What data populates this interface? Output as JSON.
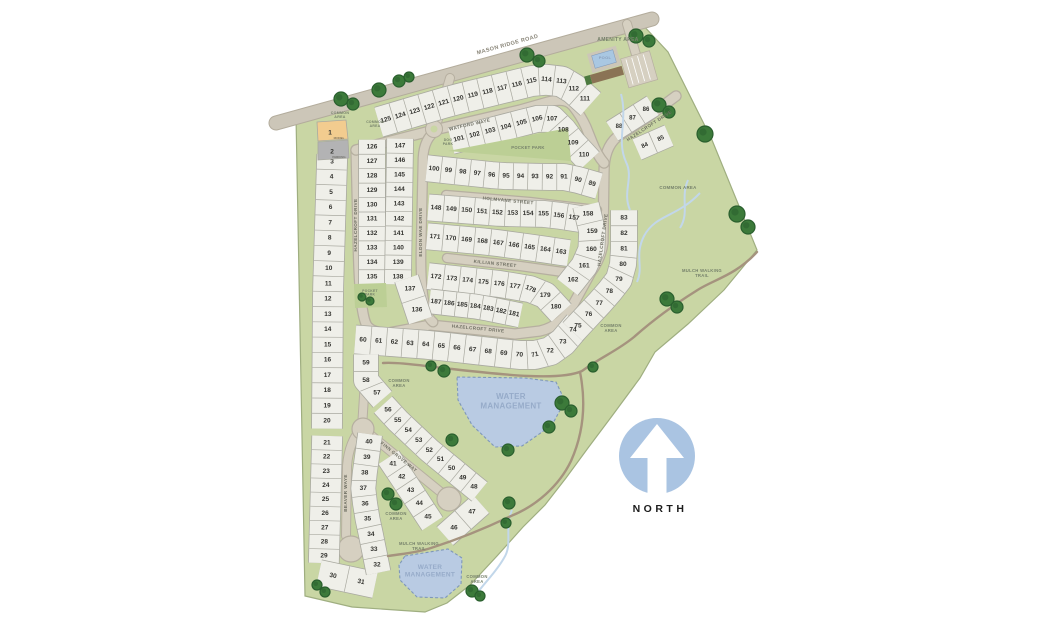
{
  "north": {
    "label": "NORTH"
  },
  "colors": {
    "background": "#ffffff",
    "parcel_green": "#c9d6a4",
    "parcel_edge": "#9fae80",
    "pocket_green": "#bccf95",
    "lot_fill": "#efefe9",
    "lot_edge": "#a9a9a0",
    "road_fill": "#d6d0c1",
    "road_edge": "#b6afa0",
    "main_road_fill": "#ccc6b8",
    "main_road_edge": "#b3ac9c",
    "water_fill": "#b9cbe3",
    "water_edge": "#7e97ba",
    "water_text": "#96abc9",
    "stream": "#c2d7ea",
    "trail": "#a5937e",
    "tree_dark": "#2a5f2e",
    "tree_mid": "#3c7a3a",
    "lot_number_text": "#33332f",
    "street_text": "#6e6e62",
    "main_street_text": "#8a8679",
    "area_text": "#75806a",
    "model_fill": "#f2cc8f",
    "parking_fill": "#b3b3b4",
    "pool_fill": "#a9c7e2",
    "building_fill": "#8a7355",
    "north_circle": "#aac4e2",
    "north_text": "#1c1c1c"
  },
  "special_lots": [
    {
      "num": "1",
      "use": "MODEL",
      "poly": "317,122 346,120 348,139 318,141",
      "nx": 330,
      "ny": 133,
      "ux": 339,
      "uy": 139,
      "fill_key": "model_fill"
    },
    {
      "num": "2",
      "use": "PARKING",
      "poly": "318,142 348,140 349,158 318,160",
      "nx": 332,
      "ny": 152,
      "ux": 339,
      "uy": 158,
      "fill_key": "parking_fill"
    }
  ],
  "lot_rows": [
    {
      "lots": [
        125,
        124,
        123,
        122,
        121,
        120,
        119,
        118,
        117,
        116,
        115,
        114,
        113,
        112,
        111
      ],
      "path": [
        [
          386,
          120
        ],
        [
          450,
          101
        ],
        [
          540,
          79
        ],
        [
          566,
          82
        ],
        [
          585,
          99
        ]
      ],
      "w": 30
    },
    {
      "lots": [
        101,
        102,
        103,
        104,
        105,
        106,
        107,
        108,
        109,
        110
      ],
      "path": [
        [
          459,
          139
        ],
        [
          529,
          121
        ],
        [
          549,
          116
        ],
        [
          561,
          127
        ],
        [
          572,
          142
        ],
        [
          584,
          155
        ]
      ],
      "w": 26
    },
    {
      "lots": [
        100,
        99,
        98,
        97,
        96,
        95,
        94,
        93,
        92,
        91,
        90,
        89
      ],
      "path": [
        [
          434,
          169
        ],
        [
          500,
          176
        ],
        [
          549,
          177
        ],
        [
          568,
          177
        ],
        [
          592,
          184
        ]
      ],
      "w": 26
    },
    {
      "lots": [
        148,
        149,
        150,
        151,
        152,
        153,
        154,
        155,
        156,
        157
      ],
      "path": [
        [
          436,
          208
        ],
        [
          500,
          213
        ],
        [
          548,
          214
        ],
        [
          574,
          218
        ]
      ],
      "w": 26
    },
    {
      "lots": [
        171,
        170,
        169,
        168,
        167,
        166,
        165,
        164,
        163
      ],
      "path": [
        [
          435,
          237
        ],
        [
          490,
          242
        ],
        [
          534,
          248
        ],
        [
          561,
          252
        ]
      ],
      "w": 26
    },
    {
      "lots": [
        172,
        173,
        174,
        175,
        176,
        177,
        178,
        179,
        180
      ],
      "path": [
        [
          436,
          277
        ],
        [
          500,
          284
        ],
        [
          530,
          289
        ],
        [
          545,
          295
        ],
        [
          556,
          307
        ]
      ],
      "w": 26
    },
    {
      "lots": [
        187,
        186,
        185,
        184,
        183,
        182,
        181
      ],
      "path": [
        [
          436,
          302
        ],
        [
          480,
          307
        ],
        [
          514,
          314
        ]
      ],
      "w": 24
    },
    {
      "lots": [
        158,
        159,
        160,
        161,
        162
      ],
      "path": [
        [
          588,
          214
        ],
        [
          593,
          235
        ],
        [
          591,
          253
        ],
        [
          582,
          270
        ],
        [
          573,
          280
        ]
      ],
      "w": 26
    },
    {
      "lots": [
        60,
        61,
        62,
        63,
        64,
        65,
        66,
        67,
        68,
        69,
        70,
        71,
        72,
        73,
        74
      ],
      "path": [
        [
          363,
          340
        ],
        [
          430,
          345
        ],
        [
          500,
          353
        ],
        [
          530,
          356
        ],
        [
          549,
          352
        ],
        [
          563,
          342
        ],
        [
          573,
          330
        ]
      ],
      "w": 28
    },
    {
      "lots": [
        75,
        76,
        77,
        78,
        79,
        80,
        81,
        82,
        83
      ],
      "path": [
        [
          578,
          326
        ],
        [
          606,
          296
        ],
        [
          620,
          278
        ],
        [
          624,
          260
        ],
        [
          624,
          218
        ]
      ],
      "w": 26
    },
    {
      "lots": [
        88,
        87,
        86
      ],
      "path": [
        [
          619,
          127
        ],
        [
          646,
          110
        ]
      ],
      "w": 22
    },
    {
      "lots": [
        84,
        85
      ],
      "path": [
        [
          645,
          146
        ],
        [
          661,
          139
        ]
      ],
      "w": 22
    },
    {
      "lots": [
        126,
        127,
        128,
        129,
        130,
        131,
        132,
        133,
        134,
        135
      ],
      "path": [
        [
          372,
          147
        ],
        [
          372,
          277
        ]
      ],
      "w": 26
    },
    {
      "lots": [
        147,
        146,
        145,
        144,
        143,
        142,
        141,
        140,
        139,
        138
      ],
      "path": [
        [
          400,
          146
        ],
        [
          398,
          277
        ]
      ],
      "w": 26
    },
    {
      "lots": [
        137,
        136
      ],
      "path": [
        [
          410,
          289
        ],
        [
          417,
          310
        ]
      ],
      "w": 24
    },
    {
      "lots": [
        3,
        4,
        5,
        6,
        7,
        8,
        9,
        10,
        11,
        12,
        13,
        14,
        15,
        16,
        17,
        18,
        19,
        20
      ],
      "path": [
        [
          332,
          162
        ],
        [
          328,
          292
        ],
        [
          327,
          421
        ]
      ],
      "w": 30
    },
    {
      "lots": [
        21,
        22,
        23,
        24,
        25,
        26,
        27,
        28,
        29
      ],
      "path": [
        [
          327,
          443
        ],
        [
          324,
          556
        ]
      ],
      "w": 30
    },
    {
      "lots": [
        30,
        31
      ],
      "path": [
        [
          333,
          576
        ],
        [
          361,
          582
        ]
      ],
      "w": 26
    },
    {
      "lots": [
        40,
        39,
        38,
        37,
        36,
        35,
        34,
        33,
        32
      ],
      "path": [
        [
          369,
          442
        ],
        [
          363,
          486
        ],
        [
          366,
          512
        ],
        [
          371,
          535
        ],
        [
          377,
          565
        ]
      ],
      "w": 24
    },
    {
      "lots": [
        41,
        42,
        43,
        44,
        45
      ],
      "path": [
        [
          393,
          464
        ],
        [
          411,
          491
        ],
        [
          428,
          517
        ]
      ],
      "w": 24
    },
    {
      "lots": [
        46,
        47
      ],
      "path": [
        [
          454,
          528
        ],
        [
          472,
          512
        ]
      ],
      "w": 24
    },
    {
      "lots": [
        48,
        49,
        50,
        51,
        52,
        53,
        54,
        55,
        56
      ],
      "path": [
        [
          474,
          487
        ],
        [
          430,
          451
        ],
        [
          396,
          419
        ],
        [
          388,
          410
        ]
      ],
      "w": 24
    },
    {
      "lots": [
        57,
        58,
        59
      ],
      "path": [
        [
          377,
          393
        ],
        [
          366,
          382
        ],
        [
          366,
          363
        ]
      ],
      "w": 24
    }
  ],
  "streets": [
    {
      "name": "MASON RIDGE ROAD",
      "x": 508,
      "y": 46,
      "rot": -15.5,
      "size": 5.5,
      "main": true
    },
    {
      "name": "WATFORD WAYE",
      "x": 470,
      "y": 126,
      "rot": -13,
      "size": 4.6
    },
    {
      "name": "HAZELCROFT DRIVE",
      "x": 357,
      "y": 225,
      "rot": -90,
      "size": 4.6
    },
    {
      "name": "ELDON WAE DRIVE",
      "x": 422,
      "y": 232,
      "rot": -90,
      "size": 4.6
    },
    {
      "name": "HOLMVANE STREET",
      "x": 508,
      "y": 202,
      "rot": 5.5,
      "size": 4.6
    },
    {
      "name": "KILLIAN STREET",
      "x": 495,
      "y": 265,
      "rot": 6,
      "size": 4.6
    },
    {
      "name": "HAZELCROFT DRIVE",
      "x": 478,
      "y": 330,
      "rot": 5.5,
      "size": 4.6
    },
    {
      "name": "HAZELCROFT DRIVE",
      "x": 604,
      "y": 240,
      "rot": -82,
      "size": 4.6
    },
    {
      "name": "HAZELCROFT DRIVE",
      "x": 650,
      "y": 127,
      "rot": -33,
      "size": 4.6
    },
    {
      "name": "FINN GROVE WAY",
      "x": 398,
      "y": 458,
      "rot": 39,
      "size": 4.6
    },
    {
      "name": "BEAVER WAYE",
      "x": 347,
      "y": 493,
      "rot": -90,
      "size": 4.6
    }
  ],
  "areas": [
    {
      "lines": [
        "AMENITY AREA"
      ],
      "x": 618,
      "y": 41,
      "size": 5,
      "ls": 0.6
    },
    {
      "lines": [
        "POOL"
      ],
      "x": 605,
      "y": 59,
      "size": 4,
      "color": "#8ba0bd"
    },
    {
      "lines": [
        "DOG",
        "PARK"
      ],
      "x": 448,
      "y": 141,
      "size": 3.4,
      "lh": 3.8
    },
    {
      "lines": [
        "COMMON",
        "AREA"
      ],
      "x": 340,
      "y": 114,
      "size": 3.6,
      "lh": 4
    },
    {
      "lines": [
        "COMMON",
        "AREA"
      ],
      "x": 375,
      "y": 123,
      "size": 3.4,
      "lh": 3.8
    },
    {
      "lines": [
        "POCKET PARK"
      ],
      "x": 528,
      "y": 149,
      "size": 4.2
    },
    {
      "lines": [
        "POCKET",
        "PARK"
      ],
      "x": 370,
      "y": 292,
      "size": 3.3,
      "lh": 3.7
    },
    {
      "lines": [
        "COMMON AREA"
      ],
      "x": 678,
      "y": 189,
      "size": 4.4
    },
    {
      "lines": [
        "MULCH WALKING",
        "TRAIL"
      ],
      "x": 702,
      "y": 272,
      "size": 4.2,
      "lh": 4.8
    },
    {
      "lines": [
        "COMMON",
        "AREA"
      ],
      "x": 611,
      "y": 327,
      "size": 4.2,
      "lh": 4.8
    },
    {
      "lines": [
        "COMMON",
        "AREA"
      ],
      "x": 399,
      "y": 382,
      "size": 4.2,
      "lh": 4.8
    },
    {
      "lines": [
        "WATER",
        "MANAGEMENT"
      ],
      "x": 511,
      "y": 399,
      "size": 8,
      "lh": 9.5,
      "color": "#96abc9",
      "ls": 0.8
    },
    {
      "lines": [
        "COMMON",
        "AREA"
      ],
      "x": 396,
      "y": 515,
      "size": 4.2,
      "lh": 4.8
    },
    {
      "lines": [
        "MULCH WALKING",
        "TRAIL"
      ],
      "x": 419,
      "y": 545,
      "size": 4.2,
      "lh": 4.8
    },
    {
      "lines": [
        "WATER",
        "MANAGEMENT"
      ],
      "x": 430,
      "y": 569,
      "size": 6.5,
      "lh": 7.5,
      "color": "#96abc9"
    },
    {
      "lines": [
        "COMMON",
        "AREA"
      ],
      "x": 477,
      "y": 578,
      "size": 4.2,
      "lh": 4.8
    }
  ],
  "trees": [
    [
      341,
      99,
      7
    ],
    [
      353,
      104,
      6
    ],
    [
      379,
      90,
      7
    ],
    [
      399,
      81,
      6
    ],
    [
      409,
      77,
      5
    ],
    [
      527,
      55,
      7
    ],
    [
      539,
      61,
      6
    ],
    [
      636,
      36,
      7
    ],
    [
      649,
      41,
      6
    ],
    [
      659,
      105,
      7
    ],
    [
      669,
      112,
      6
    ],
    [
      705,
      134,
      8
    ],
    [
      737,
      214,
      8
    ],
    [
      748,
      227,
      7
    ],
    [
      667,
      299,
      7
    ],
    [
      677,
      307,
      6
    ],
    [
      562,
      403,
      7
    ],
    [
      571,
      411,
      6
    ],
    [
      549,
      427,
      6
    ],
    [
      508,
      450,
      6
    ],
    [
      452,
      440,
      6
    ],
    [
      444,
      371,
      6
    ],
    [
      431,
      366,
      5
    ],
    [
      388,
      494,
      6
    ],
    [
      396,
      504,
      6
    ],
    [
      509,
      503,
      6
    ],
    [
      506,
      523,
      5
    ],
    [
      472,
      591,
      6
    ],
    [
      480,
      596,
      5
    ],
    [
      317,
      585,
      5
    ],
    [
      325,
      592,
      5
    ],
    [
      362,
      297,
      4
    ],
    [
      370,
      301,
      4
    ],
    [
      593,
      367,
      5
    ]
  ]
}
